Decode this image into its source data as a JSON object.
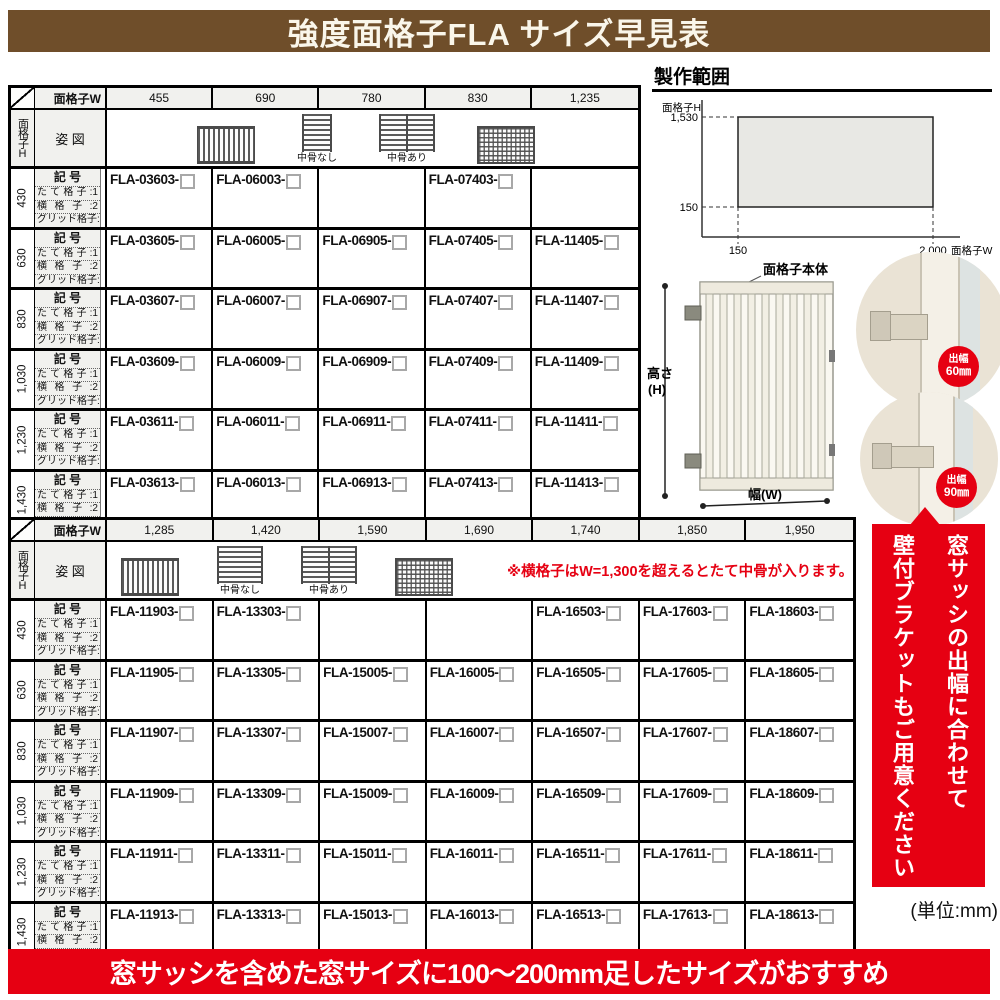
{
  "title": "強度面格子FLA サイズ早見表",
  "bottom_banner": "窓サッシを含めた窓サイズに100〜200mm足したサイズがおすすめ",
  "side_banner": {
    "line1": "窓サッシの出幅に合わせて",
    "line2": "壁付ブラケットもご用意ください"
  },
  "unit_note": "(単位:mm)",
  "colors": {
    "brand_brown": "#6f4e2a",
    "accent_red": "#e60012",
    "header_gray": "#f1f1ee"
  },
  "prod_range": {
    "title": "製作範囲",
    "h_axis": "面格子H",
    "w_axis": "面格子W",
    "h_max": "1,530",
    "h_min": "150",
    "w_min": "150",
    "w_max": "2,000"
  },
  "product": {
    "label": "面格子本体",
    "dim_h1": "高さ",
    "dim_h2": "(H)",
    "dim_w": "幅(W)",
    "badge1": {
      "t": "出幅",
      "v": "60㎜"
    },
    "badge2": {
      "t": "出幅",
      "v": "90㎜"
    }
  },
  "tables": [
    {
      "corner_label": "面格子W",
      "side_label": "面格子H",
      "figure_label": "姿 図",
      "symbol_label": "記 号",
      "legend": [
        "たて格子:1",
        "横格子:2",
        "グリッド格子:3"
      ],
      "bone_labels": [
        "中骨なし",
        "中骨あり"
      ],
      "note": "",
      "widths": [
        "455",
        "690",
        "780",
        "830",
        "1,235"
      ],
      "rows": [
        {
          "h": "430",
          "codes": [
            "FLA-03603-",
            "FLA-06003-",
            "",
            "FLA-07403-",
            ""
          ]
        },
        {
          "h": "630",
          "codes": [
            "FLA-03605-",
            "FLA-06005-",
            "FLA-06905-",
            "FLA-07405-",
            "FLA-11405-"
          ]
        },
        {
          "h": "830",
          "codes": [
            "FLA-03607-",
            "FLA-06007-",
            "FLA-06907-",
            "FLA-07407-",
            "FLA-11407-"
          ]
        },
        {
          "h": "1,030",
          "codes": [
            "FLA-03609-",
            "FLA-06009-",
            "FLA-06909-",
            "FLA-07409-",
            "FLA-11409-"
          ]
        },
        {
          "h": "1,230",
          "codes": [
            "FLA-03611-",
            "FLA-06011-",
            "FLA-06911-",
            "FLA-07411-",
            "FLA-11411-"
          ]
        },
        {
          "h": "1,430",
          "codes": [
            "FLA-03613-",
            "FLA-06013-",
            "FLA-06913-",
            "FLA-07413-",
            "FLA-11413-"
          ]
        }
      ]
    },
    {
      "corner_label": "面格子W",
      "side_label": "面格子H",
      "figure_label": "姿 図",
      "symbol_label": "記 号",
      "legend": [
        "たて格子:1",
        "横格子:2",
        "グリッド格子:3"
      ],
      "bone_labels": [
        "中骨なし",
        "中骨あり"
      ],
      "note": "※横格子はW=1,300を超えるとたて中骨が入ります。",
      "widths": [
        "1,285",
        "1,420",
        "1,590",
        "1,690",
        "1,740",
        "1,850",
        "1,950"
      ],
      "rows": [
        {
          "h": "430",
          "codes": [
            "FLA-11903-",
            "FLA-13303-",
            "",
            "",
            "FLA-16503-",
            "FLA-17603-",
            "FLA-18603-"
          ]
        },
        {
          "h": "630",
          "codes": [
            "FLA-11905-",
            "FLA-13305-",
            "FLA-15005-",
            "FLA-16005-",
            "FLA-16505-",
            "FLA-17605-",
            "FLA-18605-"
          ]
        },
        {
          "h": "830",
          "codes": [
            "FLA-11907-",
            "FLA-13307-",
            "FLA-15007-",
            "FLA-16007-",
            "FLA-16507-",
            "FLA-17607-",
            "FLA-18607-"
          ]
        },
        {
          "h": "1,030",
          "codes": [
            "FLA-11909-",
            "FLA-13309-",
            "FLA-15009-",
            "FLA-16009-",
            "FLA-16509-",
            "FLA-17609-",
            "FLA-18609-"
          ]
        },
        {
          "h": "1,230",
          "codes": [
            "FLA-11911-",
            "FLA-13311-",
            "FLA-15011-",
            "FLA-16011-",
            "FLA-16511-",
            "FLA-17611-",
            "FLA-18611-"
          ]
        },
        {
          "h": "1,430",
          "codes": [
            "FLA-11913-",
            "FLA-13313-",
            "FLA-15013-",
            "FLA-16013-",
            "FLA-16513-",
            "FLA-17613-",
            "FLA-18613-"
          ]
        }
      ]
    }
  ]
}
